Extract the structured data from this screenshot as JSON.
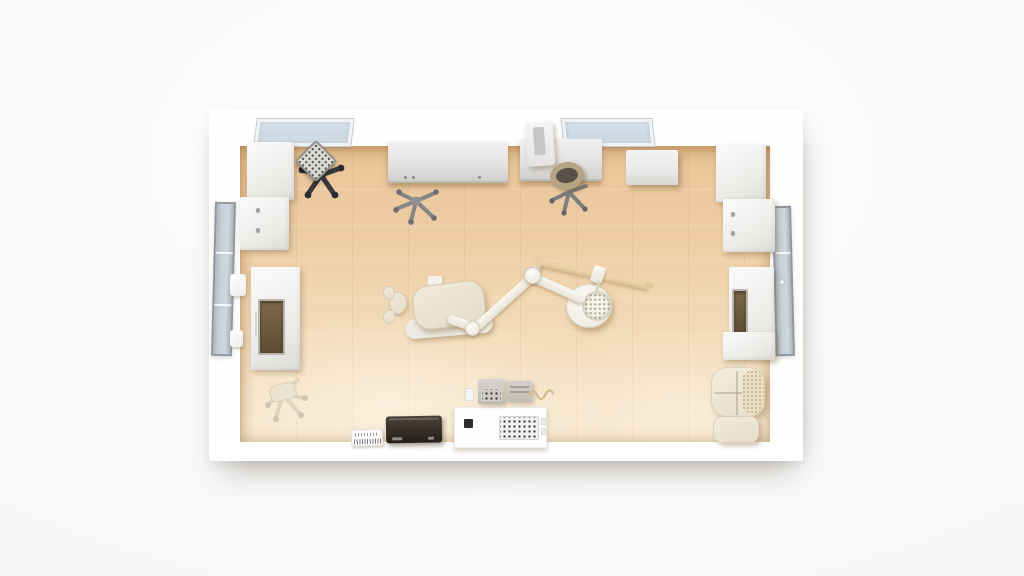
{
  "scene": {
    "description": "Top-down 3D render of a bright dental clinic operatory with white walls, light wood floor, dental chair with articulated lamp arm, desks, cabinets and a waiting armchair",
    "palette": {
      "background": "#f8f7f6",
      "wall_white": "#fefefe",
      "floor_warm": "#eecda5",
      "floor_pale": "#f6e6cc",
      "window_glass": "#ccd8e2",
      "frame_gray": "#8f979e",
      "desk_gray": "#e4e3e1",
      "cabinet_white": "#edebe8",
      "chair_dark": "#3a3a3e",
      "metal_gray": "#7f7f82",
      "upholstery_cream": "#e9e2d2",
      "wood_rod": "#e6cda4",
      "panel_brown": "#6a583b",
      "laptop_dark": "#362f29",
      "console_white": "#fdfdfd"
    },
    "objects": {
      "room": {
        "label": "Dental operatory room, top-down view"
      },
      "floor": {
        "label": "Light wood plank floor"
      },
      "skylight_left": {
        "label": "Ceiling window, left"
      },
      "skylight_right": {
        "label": "Ceiling window, right"
      },
      "left_wall_window": {
        "label": "Tall glazed panel in left wall"
      },
      "right_wall_door": {
        "label": "Tall glazed door in right wall"
      },
      "bracket_upper": {
        "label": "Wall-mounted fixture"
      },
      "bracket_lower": {
        "label": "Wall-mounted fixture"
      },
      "cabinet_left_upper": {
        "label": "White cabinet, top-left corner"
      },
      "cabinet_left_lower": {
        "label": "White cabinet with knobs, left wall"
      },
      "storage_unit_left": {
        "label": "Tall unit with dark display panel, left wall"
      },
      "stool_left": {
        "label": "Clinician stool, cream"
      },
      "chair_keyboard": {
        "label": "Dark office chair with keyboard resting on seat"
      },
      "keyboard": {
        "label": "Keyboard on chair seat"
      },
      "desk_left": {
        "label": "Work counter along top wall, left"
      },
      "chair_desk_left": {
        "label": "Office chair star base"
      },
      "desk_right": {
        "label": "Work counter along top wall, right"
      },
      "monitor": {
        "label": "Monitor standing on counter"
      },
      "stool_desk_right": {
        "label": "Round stool at counter"
      },
      "wall_shelf": {
        "label": "Wall-mounted box shelf"
      },
      "cabinet_right_upper": {
        "label": "White cabinet, top-right corner"
      },
      "cabinet_right_lower": {
        "label": "White cabinet with knobs, right wall"
      },
      "storage_unit_right": {
        "label": "Unit with dark panel, right wall"
      },
      "cabinet_right_bottom": {
        "label": "Low cabinet, right wall"
      },
      "armchair": {
        "label": "Cream waiting armchair"
      },
      "ottoman": {
        "label": "Cream ottoman"
      },
      "dental_chair": {
        "label": "Dental treatment chair, cream cushion"
      },
      "headrest": {
        "label": "Dental chair headrest"
      },
      "chair_base": {
        "label": "Dental chair base platform"
      },
      "dental_arm": {
        "label": "Articulated dental lamp arm"
      },
      "dental_lamp": {
        "label": "Round dental operating lamp"
      },
      "ceiling_rod": {
        "label": "Wooden ceiling-track rod"
      },
      "laptop": {
        "label": "Dark laptop on lower counter"
      },
      "brochure": {
        "label": "Small printed leaflet"
      },
      "control_console": {
        "label": "White control console with keypad"
      },
      "console_keypad": {
        "label": "Keypad display"
      },
      "device_left": {
        "label": "Small equipment box with keypad"
      },
      "device_right": {
        "label": "Small equipment box"
      },
      "hose": {
        "label": "Coiled instrument hose"
      },
      "switch_plate": {
        "label": "Small switch plate"
      }
    }
  }
}
